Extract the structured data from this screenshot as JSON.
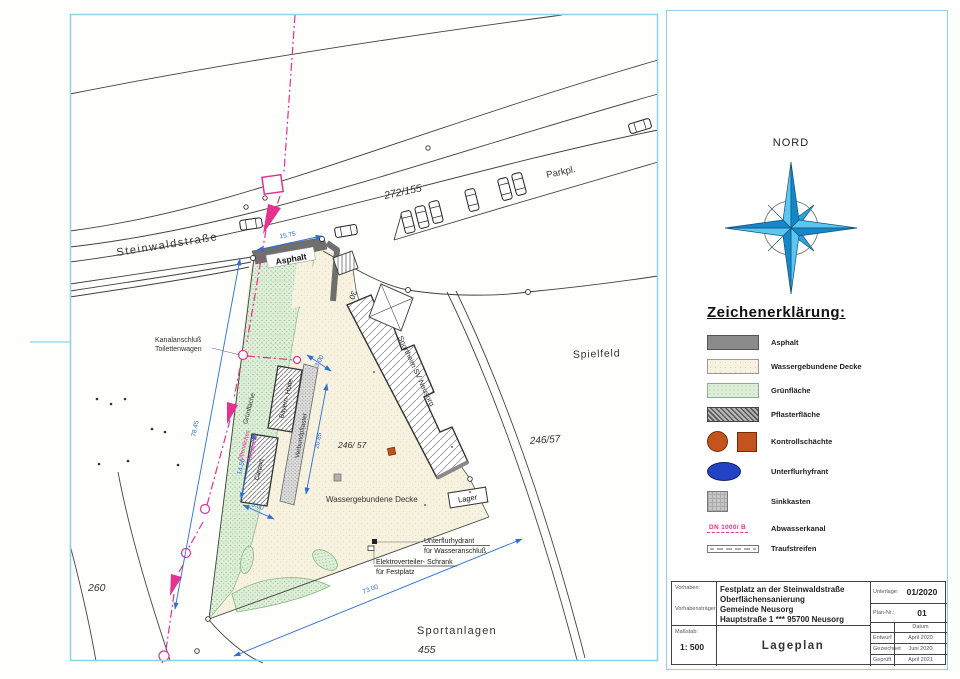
{
  "drawing": {
    "street_label": "Steinwaldstraße",
    "parking_label": "Parkpl.",
    "parcel_road": "272/155",
    "entrance_surface": "Asphalt",
    "house_number": "30",
    "kanalanschluss_line1": "Kanalanschluß",
    "kanalanschluss_line2": "Toilettenwagen",
    "gruenflaeche": "Grünfläche",
    "building_bayern": "Bayern- Hütte",
    "verbundpflaster": "Verbundpflaster",
    "carport": "Carport",
    "parcel_site": "246/ 57",
    "surface_site": "Wassergebundene Decke",
    "building_sportheim": "Sportheim SV Neusorg",
    "spielfeld": "Spielfeld",
    "parcel_spielfeld": "246/57",
    "lager": "Lager",
    "kanalnetz_line1": "Öffentliches",
    "kanalnetz_line2": "Kanalnetz",
    "hydrant_line1": "Unterflurhydrant",
    "hydrant_line2": "für Wasseranschluß",
    "elektro_line1": "Elektroverteiler- Schrank",
    "elektro_line2": "für Festplatz",
    "sportanlagen": "Sportanlagen",
    "parcel_sport": "455",
    "parcel_260": "260",
    "dim_road_width": "15.75",
    "dim_west": "78.45",
    "dim_south": "73.00",
    "dim_carport_len": "14.50",
    "dim_carport_w": "5.00",
    "dim_strip_w": "3.00",
    "dim_strip_len": "20.85"
  },
  "north": {
    "label": "NORD"
  },
  "legend": {
    "title": "Zeichenerklärung:",
    "items": [
      {
        "label": "Asphalt",
        "swatch": "asphalt"
      },
      {
        "label": "Wassergebundene Decke",
        "swatch": "cream"
      },
      {
        "label": "Grünfläche",
        "swatch": "green"
      },
      {
        "label": "Pflasterfläche",
        "swatch": "paving"
      },
      {
        "label": "Kontrollschächte",
        "swatch": "manholes"
      },
      {
        "label": "Unterflurhyfrant",
        "swatch": "hydrant"
      },
      {
        "label": "Sinkkasten",
        "swatch": "gully"
      },
      {
        "label": "Abwasserkanal",
        "swatch": "sewer",
        "annotation": "DN 1000/ B"
      },
      {
        "label": "Traufstreifen",
        "swatch": "eaves"
      }
    ]
  },
  "title_block": {
    "vorhaben_label": "Vorhaben:",
    "vorhaben_value_1": "Festplatz an der Steinwaldstraße",
    "vorhaben_value_2": "Oberflächensanierung",
    "traeger_label": "Vorhabensträger:",
    "traeger_value_1": "Gemeinde Neusorg",
    "traeger_value_2": "Hauptstraße 1 *** 95700 Neusorg",
    "massstab_label": "Maßstab:",
    "massstab_value": "1: 500",
    "plan_title": "Lageplan",
    "unterlage_label": "Unterlage:",
    "unterlage_value": "01/2020",
    "plannr_label": "Plan-Nr.:",
    "plannr_value": "01",
    "datum_header": "Datum",
    "rows": [
      {
        "label": "Entwurf",
        "value": "April 2020"
      },
      {
        "label": "Gezeichnet",
        "value": "Juni 2020"
      },
      {
        "label": "Geprüft",
        "value": "April 2021"
      }
    ]
  },
  "colors": {
    "frame": "#8ed2e4",
    "sewer_magenta": "#e5318f",
    "dimension_blue": "#2e6fd6",
    "asphalt_gray": "#6f6f6f",
    "manhole_orange": "#c4541d",
    "hydrant_blue": "#2443c4",
    "compass_light": "#5bc6f0",
    "compass_dark": "#1586c8"
  }
}
